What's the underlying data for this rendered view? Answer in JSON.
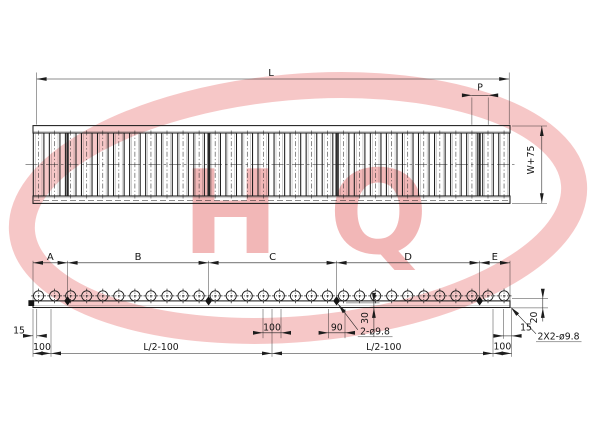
{
  "line_color": "#1c1c1c",
  "watermark": {
    "text": "HQ",
    "ring_color": "#f5baba",
    "letter_color": "#f0a6a6"
  },
  "top_view": {
    "length_label": "L",
    "pitch_label": "P",
    "width_label": "W+75",
    "roller_count": 30,
    "section_joint_count": 4
  },
  "side_view": {
    "segment_labels": [
      "A",
      "B",
      "C",
      "D",
      "E"
    ],
    "axle_count": 30,
    "dims": {
      "left_end_offset": "15",
      "left_hole_offset": "100",
      "left_half_span": "L/2-100",
      "mid_hole_spacing": "100",
      "joint_hole_spacing": "90",
      "hole_edge_distance": "30",
      "joint_holes_note": "2-ø9.8",
      "right_half_span": "L/2-100",
      "right_hole_offset": "100",
      "right_end_offset": "15",
      "rail_height": "20",
      "end_holes_note": "2X2-ø9.8"
    }
  }
}
